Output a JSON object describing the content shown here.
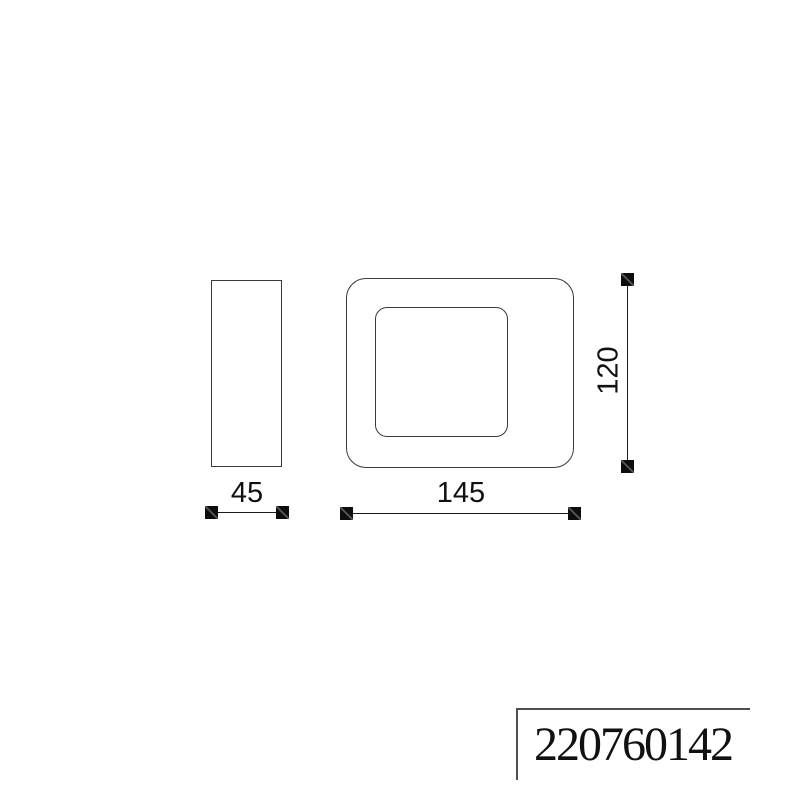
{
  "drawing": {
    "description": "technical drawing, two orthographic views of a rounded square wall lamp"
  },
  "dimensions": {
    "side_width_label": "45",
    "front_width_label": "145",
    "front_height_label": "120"
  },
  "title_block": {
    "part_number": "220760142"
  },
  "colors": {
    "outline": "#3a3a3a",
    "dimension": "#111111",
    "title_block_border": "#4f4f4f",
    "background": "#ffffff"
  }
}
